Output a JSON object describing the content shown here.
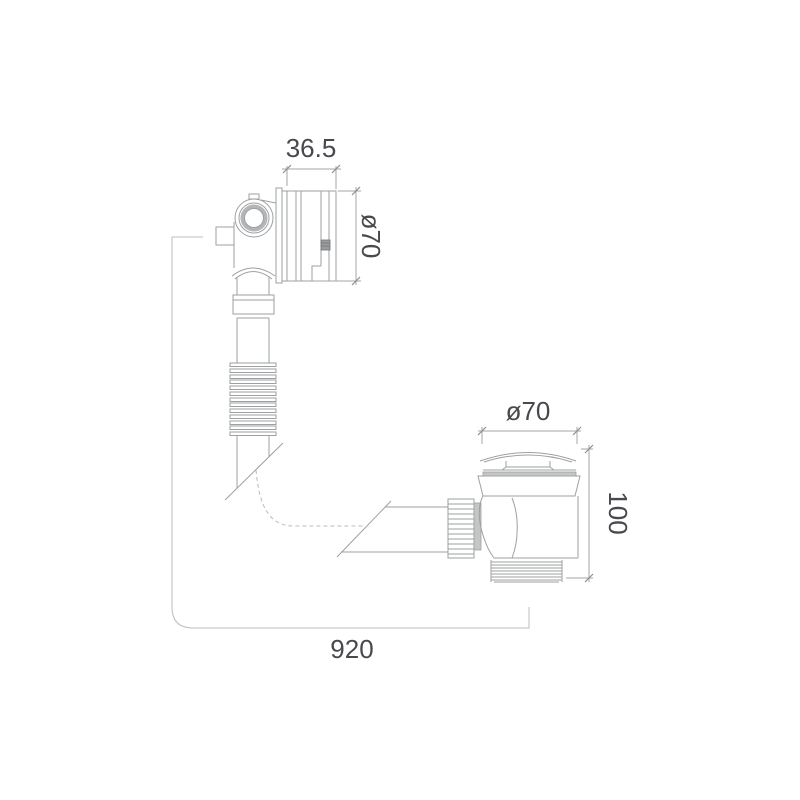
{
  "drawing": {
    "title": "Bath overflow and waste — dimensioned technical drawing",
    "units": "mm",
    "labels": {
      "overflow_depth": "36.5",
      "overflow_diameter": "ø70",
      "waste_diameter": "ø70",
      "waste_height": "100",
      "hose_length": "920"
    },
    "values": {
      "overflow_depth_mm": 36.5,
      "overflow_diameter_mm": 70,
      "waste_diameter_mm": 70,
      "waste_height_mm": 100,
      "hose_length_mm": 920
    },
    "colors": {
      "background": "#ffffff",
      "part_line": "#9da0a2",
      "dimension_line": "#a3a6a8",
      "measure_path_line": "#bcbec0",
      "text": "#47494c",
      "shading": "#c3c5c7"
    },
    "components": [
      "overflow-fitting",
      "overflow-faceplate",
      "flexible-hose",
      "horizontal-pipe",
      "compression-nut",
      "click-clack-waste",
      "threaded-tail"
    ]
  }
}
